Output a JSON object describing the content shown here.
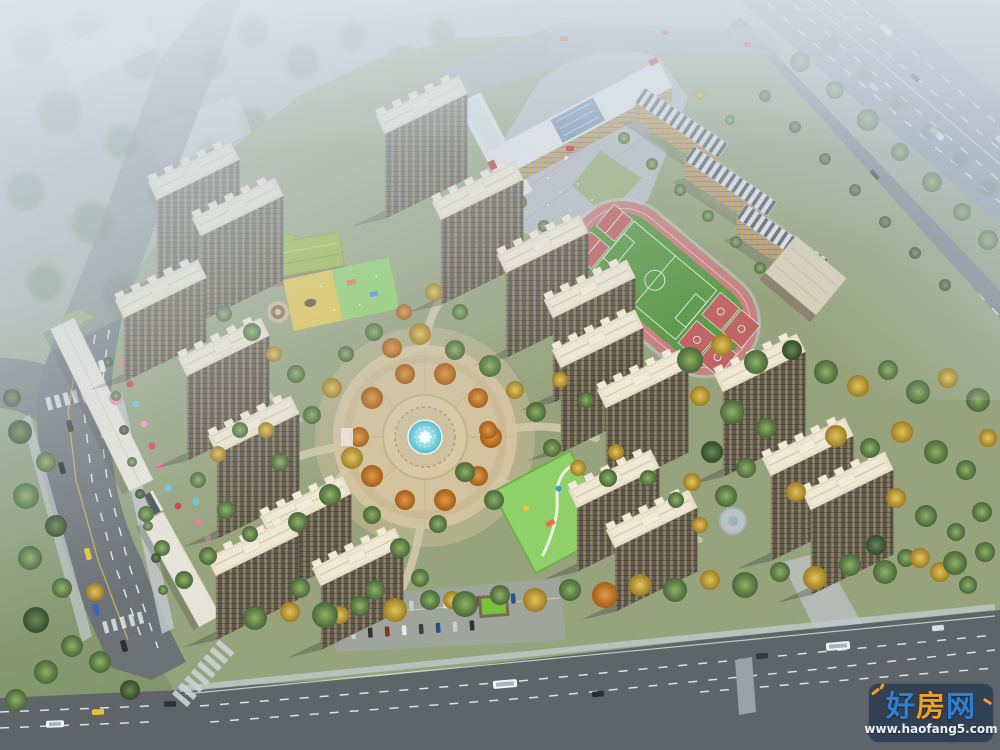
{
  "watermark": {
    "brand_char_1": "好",
    "brand_char_2": "房",
    "brand_char_3": "网",
    "url": "www.haofang5.com"
  },
  "palette": {
    "haze_blue": "#b7c5d3",
    "grass_green": "#92a07a",
    "deep_green": "#4f6b3d",
    "autumn_yellow": "#d4b542",
    "autumn_orange": "#c97a2e",
    "asphalt": "#6d7277",
    "asphalt_dark": "#5f6468",
    "sidewalk": "#c3c7cb",
    "roof_cream": "#e8e0c9",
    "facade_taupe": "#5f584a",
    "school_roof_white": "#e4e6e8",
    "school_stripe_dark": "#5a6067",
    "school_window_orange": "#d79a36",
    "track_red": "#c98080",
    "pitch_green": "#5d9a4a",
    "court_red": "#bf6565",
    "kindergarten_roof_green": "#9ab83f",
    "playground_yellow": "#e4c74b",
    "playground_green": "#8fd069",
    "pool_cyan": "#5ec6d6",
    "plaza_tan": "#d2c29e",
    "wm_blue": "#2f80cf",
    "wm_orange": "#f3a01f",
    "wm_url_white": "#eef3f7",
    "wm_badge_bg": "rgba(14,36,70,0.55)"
  }
}
